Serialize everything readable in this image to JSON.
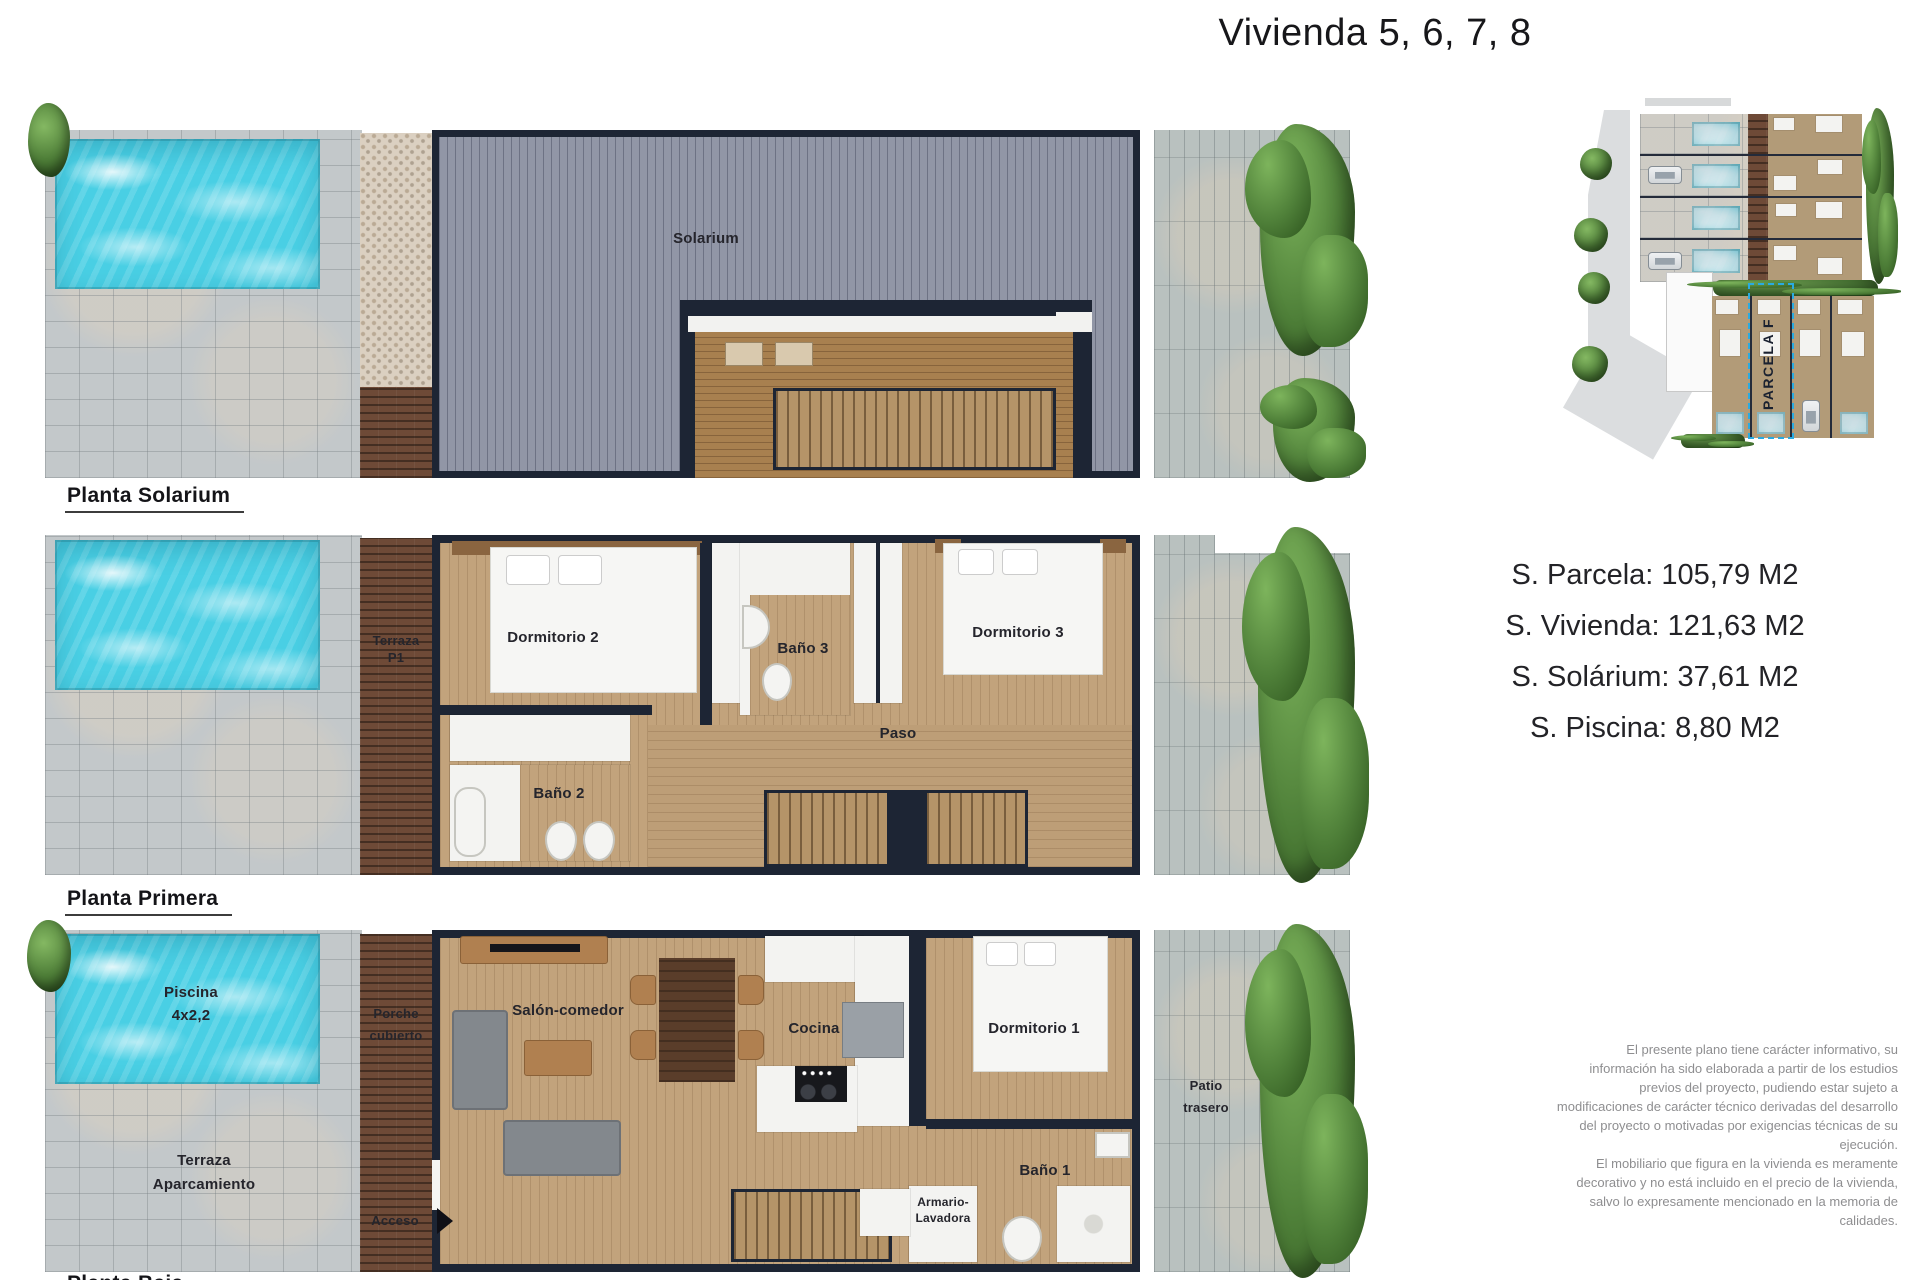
{
  "title": "Vivienda 5, 6, 7, 8",
  "plans": {
    "solarium": {
      "label": "Planta Solarium",
      "rooms": {
        "solarium": "Solarium"
      }
    },
    "primera": {
      "label": "Planta Primera",
      "rooms": {
        "terraza_l1": "Terraza",
        "terraza_l2": "P1",
        "dormitorio2": "Dormitorio 2",
        "bano3": "Baño 3",
        "dormitorio3": "Dormitorio 3",
        "bano2": "Baño 2",
        "paso": "Paso"
      }
    },
    "baja": {
      "label": "Planta Baja",
      "rooms": {
        "piscina_l1": "Piscina",
        "piscina_l2": "4x2,2",
        "terraza_l1": "Terraza",
        "terraza_l2": "Aparcamiento",
        "porche_l1": "Porche",
        "porche_l2": "cubierto",
        "acceso": "Acceso",
        "salon": "Salón-comedor",
        "cocina": "Cocina",
        "dormitorio1": "Dormitorio 1",
        "armario_l1": "Armario-",
        "armario_l2": "Lavadora",
        "bano1": "Baño 1",
        "patio_l1": "Patio",
        "patio_l2": "trasero"
      }
    }
  },
  "site_plan": {
    "parcel_label": "PARCELA F"
  },
  "measurements": {
    "parcela": "S. Parcela: 105,79 M2",
    "vivienda": "S. Vivienda: 121,63 M2",
    "solarium": "S. Solárium: 37,61 M2",
    "piscina": "S. Piscina: 8,80 M2"
  },
  "disclaimer": {
    "p1": "El presente plano tiene carácter informativo, su información ha sido elaborada a partir de los estudios previos del proyecto, pudiendo estar sujeto a modificaciones de carácter técnico derivadas del desarrollo del proyecto o motivadas por exigencias técnicas de su ejecución.",
    "p2": "El mobiliario que figura en la vivienda es meramente decorativo y no está incluido en el precio de la vivienda, salvo lo expresamente mencionado en la memoria de calidades."
  },
  "colors": {
    "pool": "#49cfe4",
    "wall": "#1d2534",
    "wood_floor": "#c2a37c",
    "dark_wood": "#6e4a37",
    "deck_gray": "#9196a6",
    "paver": "#c3c8ca",
    "tree_green": "#4e7e38",
    "parcel_outline": "#29abe2"
  }
}
